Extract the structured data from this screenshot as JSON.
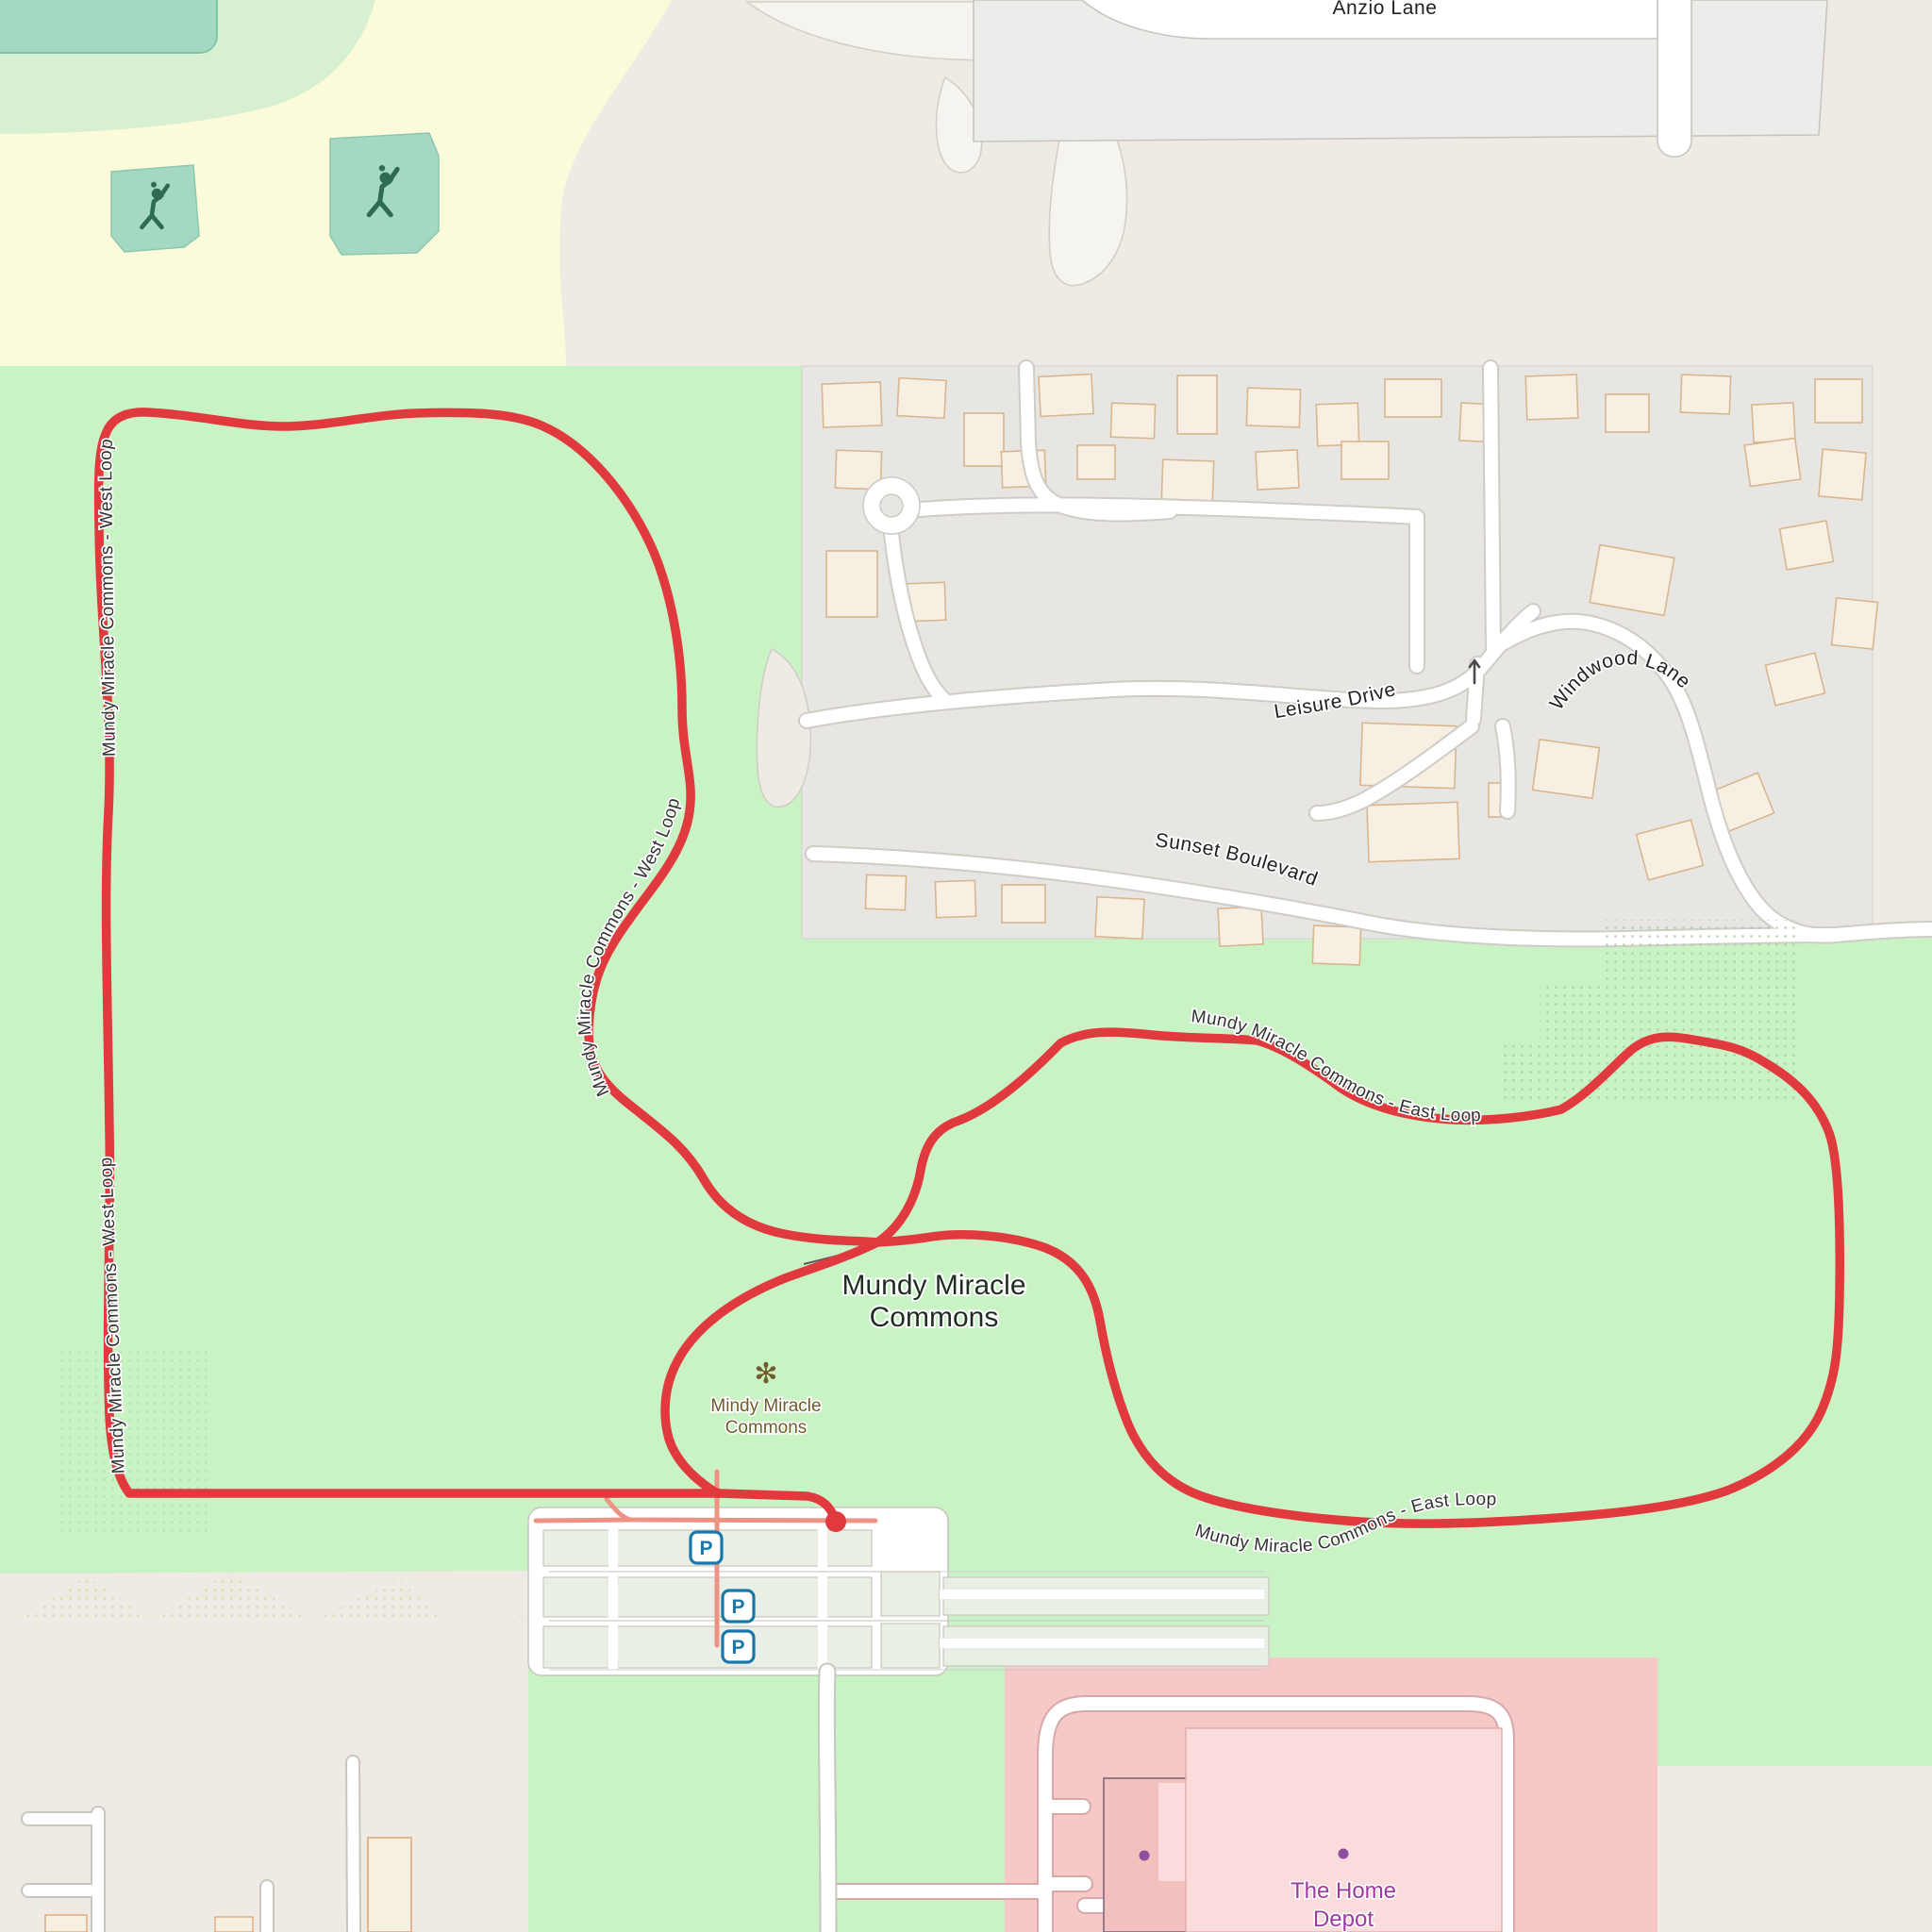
{
  "map": {
    "place_label": {
      "line1": "Mundy Miracle",
      "line2": "Commons"
    },
    "park_poi": {
      "glyph": "✻",
      "line1": "Mindy Miracle",
      "line2": "Commons"
    },
    "trails": {
      "west": {
        "name": "Mundy Miracle Commons - West Loop"
      },
      "east": {
        "name": "Mundy Miracle Commons - East Loop"
      }
    },
    "streets": {
      "anzio": "Anzio Lane",
      "leisure": "Leisure Drive",
      "windwood": "Windwood Lane",
      "sunset": "Sunset Boulevard"
    },
    "retail": {
      "line1": "The Home",
      "line2": "Depot"
    },
    "parking": {
      "symbol": "P"
    },
    "icons": {
      "pitch": "baseball-player-icon",
      "flower": "park-flower-icon",
      "oneway": "oneway-arrow-icon",
      "endpoint": "route-endpoint-dot"
    },
    "colors": {
      "park_green": "#c9f2c5",
      "school_yellow": "#fbfbdb",
      "base_beige": "#efeae3",
      "residential_gray": "#e8e6e3",
      "retail_pink": "#f6c8c8",
      "route_red": "#e0393e",
      "footway_salmon": "#ec9383",
      "pitch_teal": "#a5d8c3",
      "parking_blue": "#1878ab",
      "retail_purple": "#9c3a9e",
      "park_label_brown": "#6f5e2a"
    }
  }
}
